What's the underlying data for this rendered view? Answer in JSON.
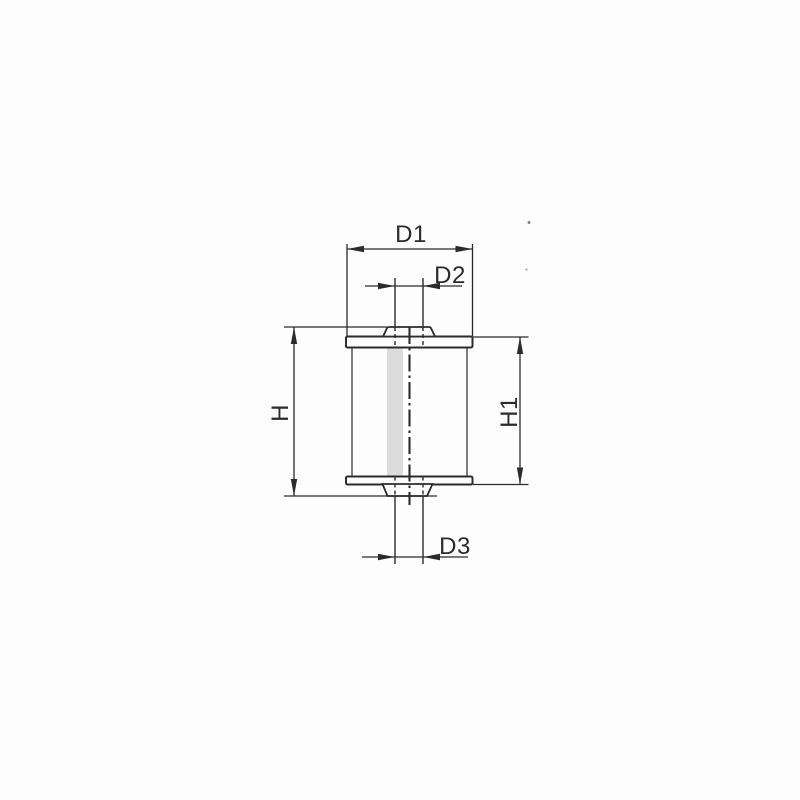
{
  "dimension_labels": {
    "d1": "D1",
    "d2": "D2",
    "d3": "D3",
    "h": "H",
    "h1": "H1"
  },
  "colors": {
    "line": "#2b2b2b",
    "paper": "#fdfdfd"
  }
}
